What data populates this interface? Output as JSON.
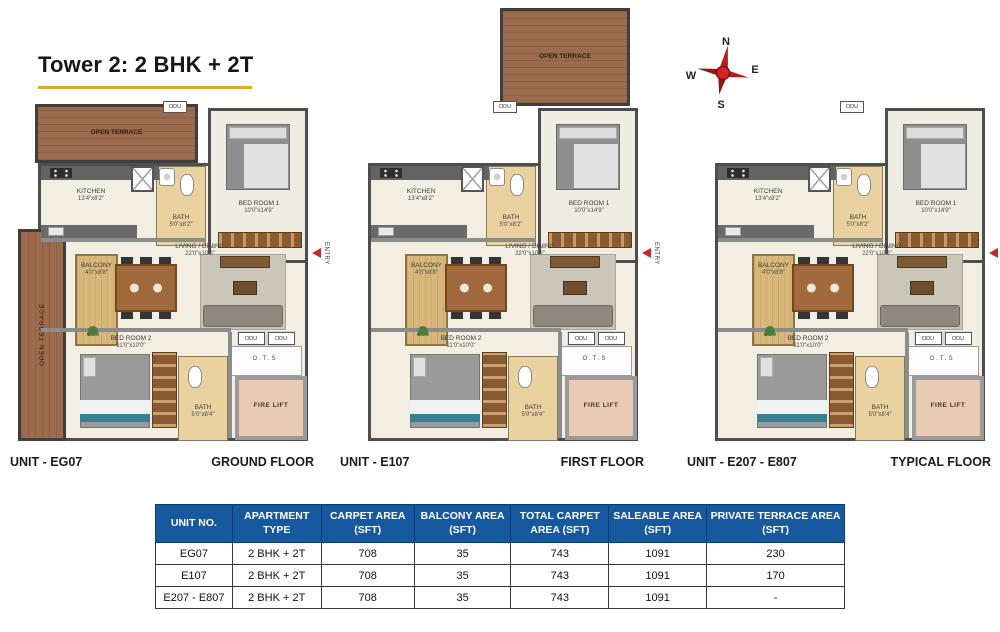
{
  "page": {
    "title": "Tower 2: 2 BHK + 2T"
  },
  "compass": {
    "north": "N",
    "east": "E",
    "south": "S",
    "west": "W"
  },
  "rooms": {
    "open_terrace": "OPEN TERRACE",
    "odu": "ODU",
    "kitchen": {
      "name": "KITCHEN",
      "dim": "13'4\"x8'2\""
    },
    "bath1": {
      "name": "BATH",
      "dim": "5'0\"x8'2\""
    },
    "bedroom1": {
      "name": "BED ROOM 1",
      "dim": "10'0\"x14'9\""
    },
    "living": {
      "name": "LIVING / DINING",
      "dim": "22'0\"x10'0\""
    },
    "balcony": {
      "name": "BALCONY",
      "dim": "4'0\"x8'8\""
    },
    "bedroom2": {
      "name": "BED ROOM 2",
      "dim": "11'0\"x10'0\""
    },
    "bath2": {
      "name": "BATH",
      "dim": "5'0\"x8'4\""
    },
    "ots": "O.T.S",
    "fire_lift": "FIRE LIFT",
    "entry": "ENTRY"
  },
  "plans": [
    {
      "unit_label": "UNIT - EG07",
      "floor_label": "GROUND FLOOR",
      "features": {
        "top_left_terrace": true,
        "left_terrace": true,
        "top_terrace": false
      }
    },
    {
      "unit_label": "UNIT - E107",
      "floor_label": "FIRST FLOOR",
      "features": {
        "top_left_terrace": false,
        "left_terrace": false,
        "top_terrace": true
      }
    },
    {
      "unit_label": "UNIT - E207 - E807",
      "floor_label": "TYPICAL FLOOR",
      "features": {
        "top_left_terrace": false,
        "left_terrace": false,
        "top_terrace": false
      }
    }
  ],
  "table": {
    "headers": [
      "UNIT NO.",
      "APARTMENT TYPE",
      "CARPET AREA (SFT)",
      "BALCONY AREA (SFT)",
      "TOTAL CARPET AREA (SFT)",
      "SALEABLE AREA (SFT)",
      "PRIVATE TERRACE AREA (SFT)"
    ],
    "rows": [
      [
        "EG07",
        "2 BHK + 2T",
        "708",
        "35",
        "743",
        "1091",
        "230"
      ],
      [
        "E107",
        "2 BHK + 2T",
        "708",
        "35",
        "743",
        "1091",
        "170"
      ],
      [
        "E207 - E807",
        "2 BHK + 2T",
        "708",
        "35",
        "743",
        "1091",
        "-"
      ]
    ]
  },
  "colors": {
    "accent_gold": "#E3A72F",
    "table_header_blue": "#17599E",
    "terrace_brown": "#9C6A4C",
    "entry_red": "#C62828"
  }
}
